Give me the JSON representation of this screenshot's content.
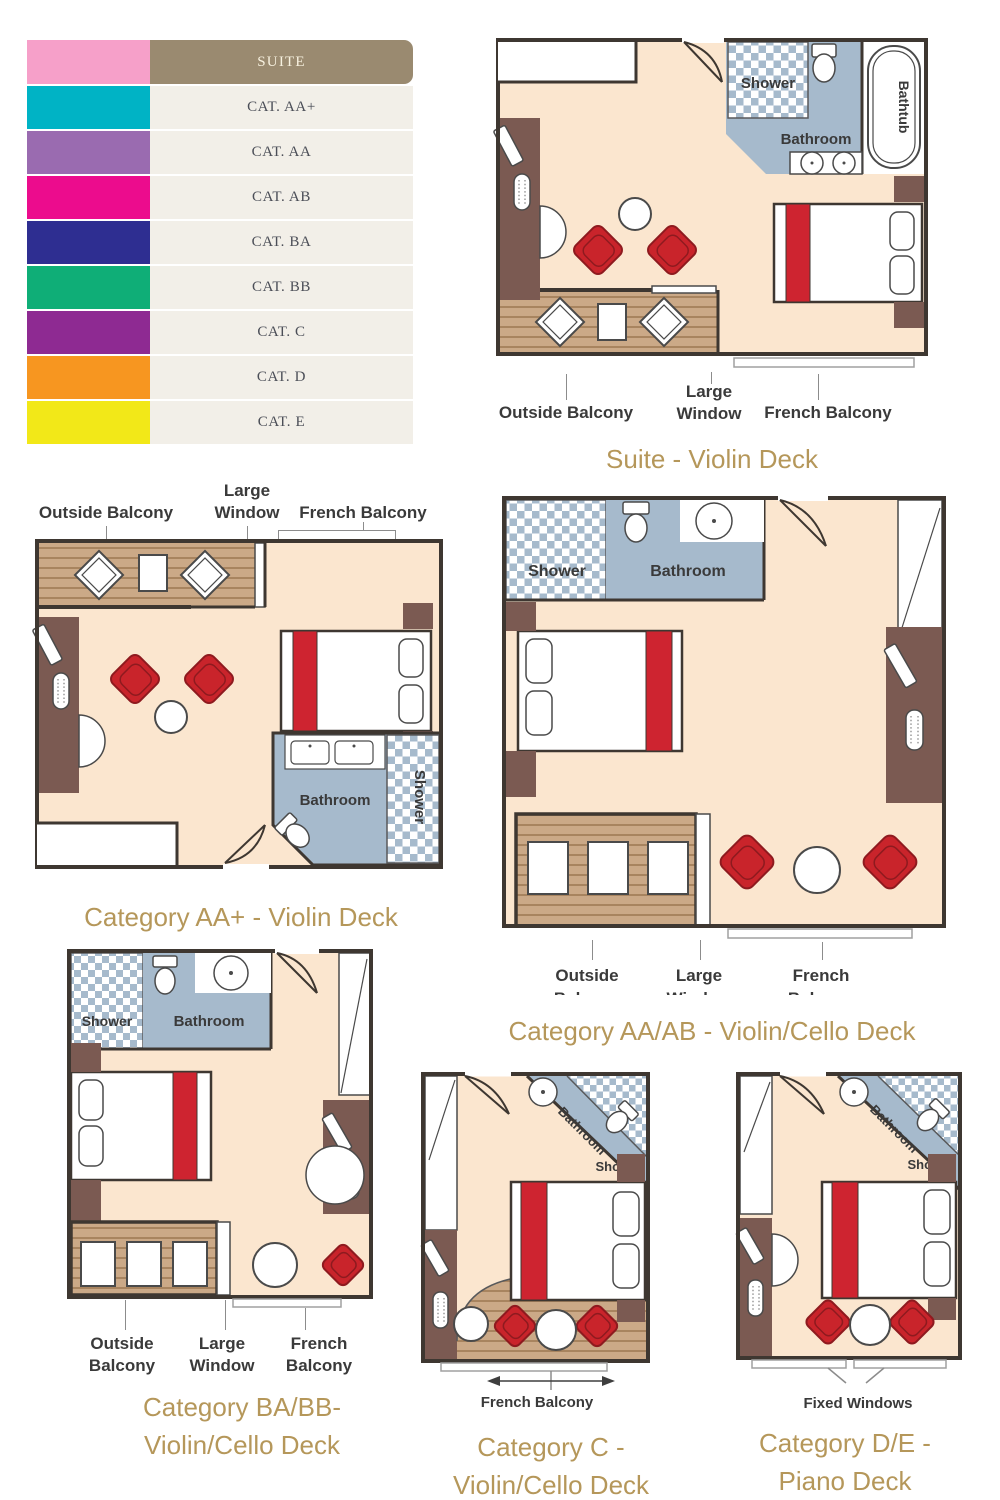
{
  "colors": {
    "title_gold": "#B5975A",
    "label_text": "#3A3A3A",
    "floor_peach": "#FBE6CF",
    "bathroom_blue": "#A6BACC",
    "wood": "#CBA987",
    "wood_plank": "#A8845F",
    "furniture_brown": "#7B5A52",
    "chair_red": "#C9242B",
    "bed_stripe_red": "#CE2430",
    "wall": "#3E3731",
    "legend_row_bg": "#F2EFE8",
    "legend_header_bg": "#9A8A70"
  },
  "legend": {
    "header": {
      "label": "SUITE",
      "swatch": "#F6A0C9"
    },
    "rows": [
      {
        "label": "CAT. AA+",
        "swatch": "#00B3C5"
      },
      {
        "label": "CAT. AA",
        "swatch": "#9A6BB0"
      },
      {
        "label": "CAT. AB",
        "swatch": "#EC0C8D"
      },
      {
        "label": "CAT. BA",
        "swatch": "#2E2E91"
      },
      {
        "label": "CAT. BB",
        "swatch": "#0FAE77"
      },
      {
        "label": "CAT. C",
        "swatch": "#8E2A92"
      },
      {
        "label": "CAT. D",
        "swatch": "#F79620"
      },
      {
        "label": "CAT. E",
        "swatch": "#F2E818"
      }
    ]
  },
  "plans": {
    "suite": {
      "title": "Suite - Violin Deck",
      "shower": "Shower",
      "bathroom": "Bathroom",
      "bathtub": "Bathtub",
      "outside_balcony": "Outside Balcony",
      "large_window_line1": "Large",
      "large_window_line2": "Window",
      "french_balcony": "French Balcony"
    },
    "aa_plus": {
      "title": "Category AA+ - Violin Deck",
      "shower": "Shower",
      "bathroom": "Bathroom",
      "outside_balcony": "Outside Balcony",
      "large_window_line1": "Large",
      "large_window_line2": "Window",
      "french_balcony": "French Balcony"
    },
    "aa_ab": {
      "title": "Category AA/AB - Violin/Cello Deck",
      "shower": "Shower",
      "bathroom": "Bathroom",
      "outside_line1": "Outside",
      "outside_line2": "Balcony",
      "large_line1": "Large",
      "large_line2": "Window",
      "french_line1": "French",
      "french_line2": "Balcony"
    },
    "ba_bb": {
      "title_line1": "Category BA/BB-",
      "title_line2": "Violin/Cello Deck",
      "shower": "Shower",
      "bathroom": "Bathroom",
      "outside_line1": "Outside",
      "outside_line2": "Balcony",
      "large_line1": "Large",
      "large_line2": "Window",
      "french_line1": "French",
      "french_line2": "Balcony"
    },
    "c": {
      "title_line1": "Category C -",
      "title_line2": "Violin/Cello Deck",
      "shower": "Shower",
      "bathroom": "Bathroom",
      "french_balcony": "French Balcony"
    },
    "de": {
      "title_line1": "Category D/E -",
      "title_line2": "Piano Deck",
      "shower": "Shower",
      "bathroom": "Bathroom",
      "fixed_windows": "Fixed Windows"
    }
  }
}
